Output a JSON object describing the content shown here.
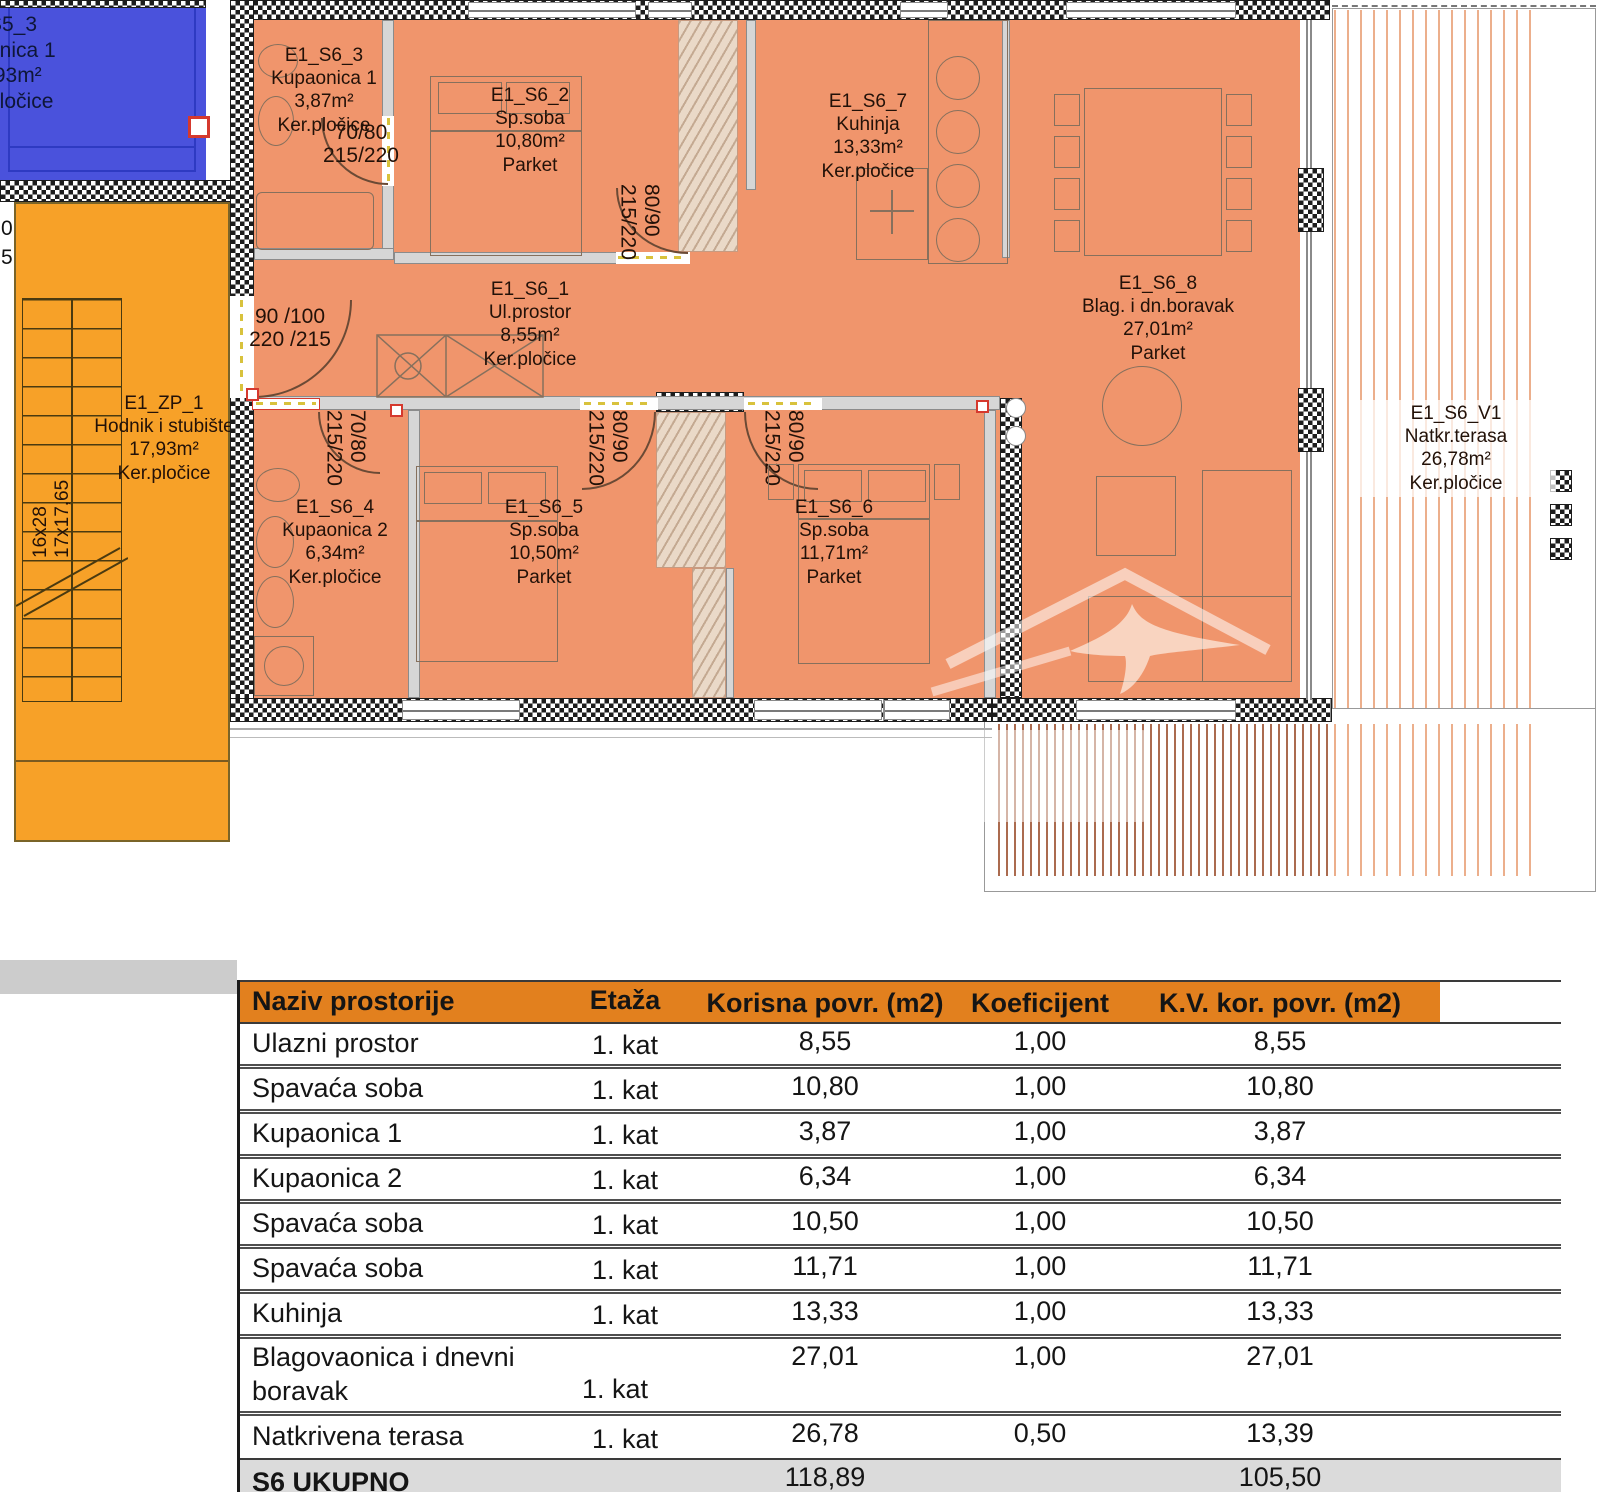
{
  "colors": {
    "apartment_fill": "#F0956C",
    "stairwell_fill": "#F7A128",
    "neighbor_unit_fill": "#4A52DC",
    "table_header": "#E2801E",
    "total_row_gray": "#DBDBDB",
    "wall_hatch": "#1D1D1D",
    "deck_stripe": "#B05A30",
    "red_accent": "#D5392E",
    "yellow_accent": "#D8C23C"
  },
  "plan": {
    "neighbor_unit": {
      "id": "S5_3",
      "name": "onica 1",
      "area": ",93m²",
      "floor": "pločice"
    },
    "edge_labels": {
      "a": "0",
      "b": "5"
    },
    "stairwell": {
      "id": "E1_ZP_1",
      "name": "Hodnik i stubište",
      "area": "17,93m²",
      "floor": "Ker.pločice",
      "tread": "16x28",
      "rise": "17x17,65"
    },
    "rooms": [
      {
        "id": "E1_S6_3",
        "name": "Kupaonica 1",
        "area": "3,87m²",
        "floor": "Ker.pločice"
      },
      {
        "id": "E1_S6_2",
        "name": "Sp.soba",
        "area": "10,80m²",
        "floor": "Parket"
      },
      {
        "id": "E1_S6_7",
        "name": "Kuhinja",
        "area": "13,33m²",
        "floor": "Ker.pločice"
      },
      {
        "id": "E1_S6_8",
        "name": "Blag. i dn.boravak",
        "area": "27,01m²",
        "floor": "Parket"
      },
      {
        "id": "E1_S6_1",
        "name": "Ul.prostor",
        "area": "8,55m²",
        "floor": "Ker.pločice"
      },
      {
        "id": "E1_S6_4",
        "name": "Kupaonica 2",
        "area": "6,34m²",
        "floor": "Ker.pločice"
      },
      {
        "id": "E1_S6_5",
        "name": "Sp.soba",
        "area": "10,50m²",
        "floor": "Parket"
      },
      {
        "id": "E1_S6_6",
        "name": "Sp.soba",
        "area": "11,71m²",
        "floor": "Parket"
      },
      {
        "id": "E1_S6_V1",
        "name": "Natkr.terasa",
        "area": "26,78m²",
        "floor": "Ker.pločice"
      }
    ],
    "doors": [
      {
        "size": "70/80",
        "height": "215/220"
      },
      {
        "size": "90 /100",
        "height": "220 /215"
      },
      {
        "size": "80/90",
        "height": "215/220"
      },
      {
        "size": "70/80",
        "height": "215/220"
      },
      {
        "size": "80/90",
        "height": "215/220"
      },
      {
        "size": "80/90",
        "height": "215/220"
      }
    ]
  },
  "table": {
    "header": [
      "Naziv prostorije",
      "Etaža",
      "Korisna povr. (m2)",
      "Koeficijent",
      "K.V. kor. povr. (m2)"
    ],
    "rows": [
      [
        "Ulazni prostor",
        "1. kat",
        "8,55",
        "1,00",
        "8,55"
      ],
      [
        "Spavaća soba",
        "1. kat",
        "10,80",
        "1,00",
        "10,80"
      ],
      [
        "Kupaonica 1",
        "1. kat",
        "3,87",
        "1,00",
        "3,87"
      ],
      [
        "Kupaonica 2",
        "1. kat",
        "6,34",
        "1,00",
        "6,34"
      ],
      [
        "Spavaća soba",
        "1. kat",
        "10,50",
        "1,00",
        "10,50"
      ],
      [
        "Spavaća soba",
        "1. kat",
        "11,71",
        "1,00",
        "11,71"
      ],
      [
        "Kuhinja",
        "1. kat",
        "13,33",
        "1,00",
        "13,33"
      ],
      [
        "Blagovaonica i dnevni boravak",
        "1. kat",
        "27,01",
        "1,00",
        "27,01"
      ],
      [
        "Natkrivena terasa",
        "1. kat",
        "26,78",
        "0,50",
        "13,39"
      ]
    ],
    "total": {
      "label": "S6 UKUPNO",
      "korisna": "118,89",
      "kv": "105,50"
    }
  }
}
